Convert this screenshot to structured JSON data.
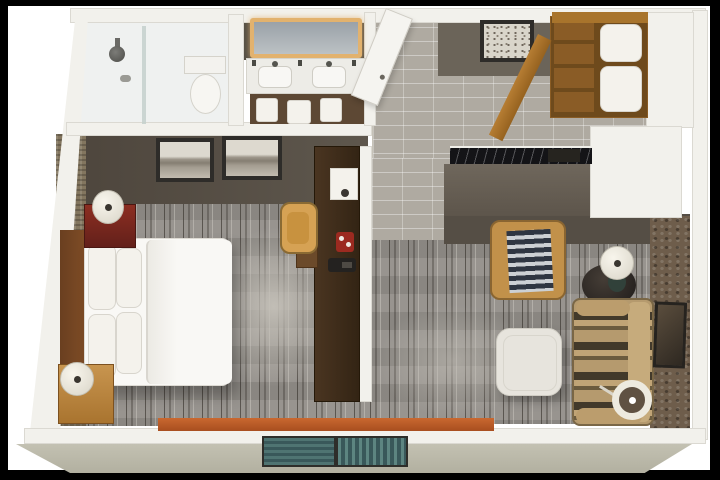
{
  "meta": {
    "kind": "3D floor plan rendering",
    "description": "Top-down 3D rendering of a hotel guest suite: bathroom with walk-in shower, double-sink vanity, entry hall with linen closet, king bedroom, work desk on a media divider, wet bar and living area with sofa, armchair and ottoman",
    "text_visible": "none"
  },
  "palette": {
    "frame": "#000000",
    "background": "#ffffff",
    "wall": "#f2f1ec",
    "wall_face": "#564f46",
    "tile": "#afaaa1",
    "carpet": "#928e89",
    "carpet_streak": "#3a342e",
    "wood_dark": "#42301f",
    "wood_warm": "#b1792f",
    "bed_linen": "#f8f7f4",
    "nightstand_red": "#7a241c",
    "chair_tan": "#d4a050",
    "sofa_tan": "#b59a6e",
    "window_teal": "#48706d",
    "ledge_orange": "#bb5c28",
    "exterior_wall": "#b9b7a8"
  },
  "rooms": {
    "bathroom": {
      "label": "Bathroom",
      "shower": "Walk-in shower",
      "shower_head": "Rain shower head",
      "glass": "Glass shower panel",
      "toilet": "Toilet"
    },
    "vanity": {
      "label": "Vanity area",
      "mirror": "Backlit vanity mirror",
      "counter": "Double-sink vanity counter",
      "sink_left": "Left sink",
      "sink_right": "Right sink",
      "cabinet": "Vanity cabinet with towels",
      "towel": "Folded white towel"
    },
    "entry": {
      "label": "Entry hall",
      "door": "Entry door (open)",
      "artwork": "Framed botanical print",
      "closet": "Open closet with spare pillows and linens",
      "closet_door": "Open closet door",
      "floor": "Porcelain tile floor"
    },
    "kitchenette": {
      "label": "Wet bar",
      "counter": "Black marble wet-bar counter",
      "cabinet": "Wet-bar cabinet",
      "items": "Coffee maker and supplies"
    },
    "bedroom": {
      "label": "Bedroom",
      "artwork_left": "Framed mountain print (left)",
      "artwork_right": "Framed mountain print (right)",
      "bed": "King bed with white duvet",
      "pillow": "White pillow",
      "headboard": "Wood headboard",
      "nightstand_top": "Red bedside cabinet",
      "lamp_top": "Round bedside lamp",
      "nightstand_bottom": "Wood nightstand",
      "lamp_bottom": "Round bedside lamp",
      "carpet": "Gray striated carpet",
      "wallpaper": "Textured accent wallpaper"
    },
    "work_area": {
      "label": "Work area",
      "console": "Dark wood media console room divider",
      "wall_lamp": "Mounted task lamp",
      "desk": "Built-in work desk",
      "chair": "Tan desk chair",
      "tray": "Red coffee tray",
      "phone": "Telephone"
    },
    "living": {
      "label": "Living area",
      "armchair": "Tan armchair with striped throw",
      "side_table": "Round dark side table",
      "table_lamp": "Table lamp",
      "sofa": "Striped sleeper sofa",
      "ottoman": "White ottoman",
      "floor_lamp": "Arc floor lamp",
      "artwork": "Framed wall art",
      "wallpaper": "Stone-textured accent wall"
    },
    "exterior": {
      "label": "Exterior",
      "window": "Window with teal glazing",
      "ledge": "Orange window ledge",
      "outer_wall": "Beveled exterior wall"
    }
  }
}
